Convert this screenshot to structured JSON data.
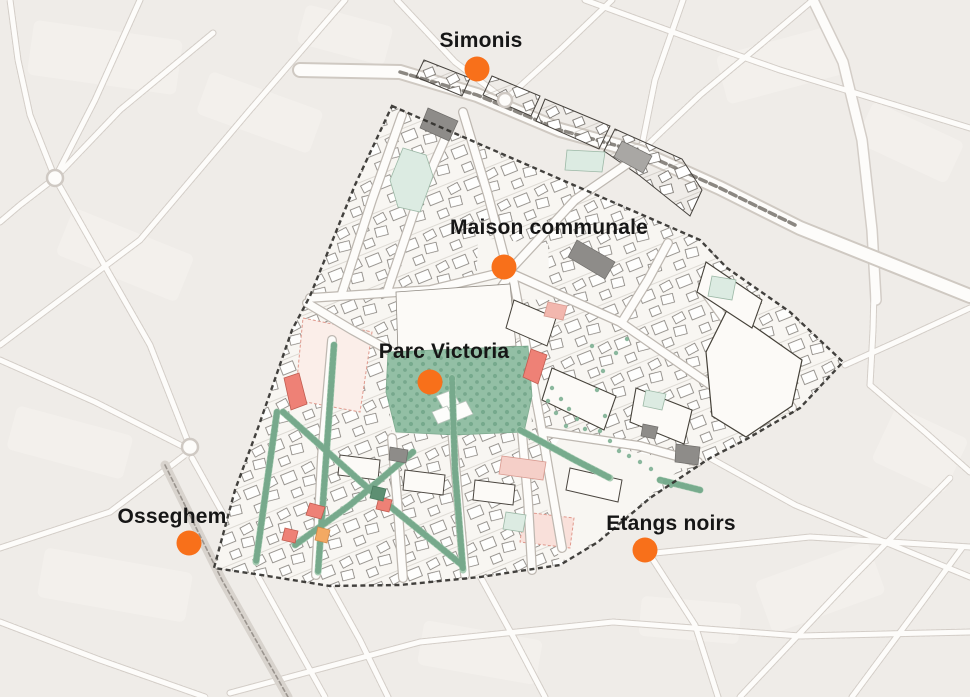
{
  "map": {
    "type": "urban-district-plan",
    "markers": [
      {
        "id": "simonis",
        "label": "Simonis",
        "dot": {
          "x": 477,
          "y": 69
        },
        "label_pos": {
          "x": 481,
          "y": 41
        }
      },
      {
        "id": "maison-communale",
        "label": "Maison communale",
        "dot": {
          "x": 504,
          "y": 267
        },
        "label_pos": {
          "x": 549,
          "y": 228
        }
      },
      {
        "id": "parc-victoria",
        "label": "Parc Victoria",
        "dot": {
          "x": 430,
          "y": 382
        },
        "label_pos": {
          "x": 444,
          "y": 352
        }
      },
      {
        "id": "osseghem",
        "label": "Osseghem",
        "dot": {
          "x": 189,
          "y": 543
        },
        "label_pos": {
          "x": 172,
          "y": 517
        }
      },
      {
        "id": "etangs-noirs",
        "label": "Etangs noirs",
        "dot": {
          "x": 645,
          "y": 550
        },
        "label_pos": {
          "x": 671,
          "y": 524
        }
      }
    ],
    "marker_style": {
      "color": "#f8701a",
      "diameter_px": 25
    },
    "label_style": {
      "color": "#161616",
      "font_size_px": 21,
      "font_weight": "bold"
    },
    "palette": {
      "background": "#efece8",
      "block_light": "#f6f3ef",
      "street_fill": "#fdfcfa",
      "street_casing": "#d3cdc7",
      "district_fill": "#f8f6f2",
      "district_boundary": "#2f2d2a",
      "building_outline": "#454139",
      "building_gray": "#8e8c89",
      "park_green": "#93bfa5",
      "tree_green": "#69a081",
      "corridor_green": "#a8ccb3",
      "pond_green": "#dcebe2",
      "accent_red": "#ee8176",
      "accent_pink": "#f5cfc8",
      "accent_orange": "#f3a963"
    }
  }
}
